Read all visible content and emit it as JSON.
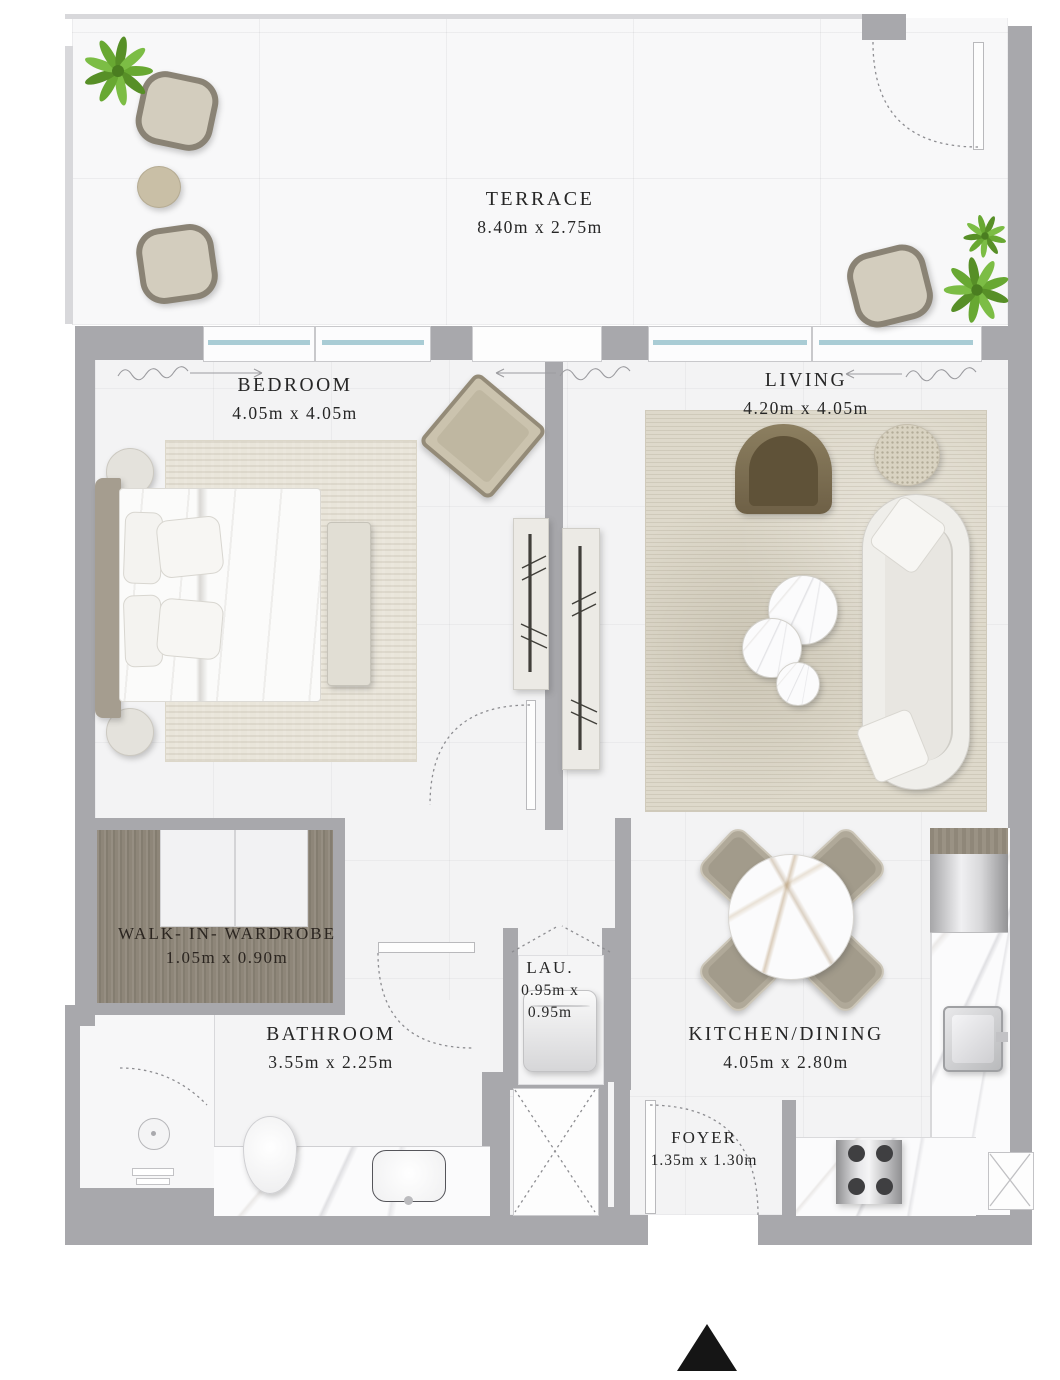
{
  "plan": {
    "rooms": [
      {
        "id": "terrace",
        "name": "TERRACE",
        "dims": "8.40m x 2.75m"
      },
      {
        "id": "bedroom",
        "name": "BEDROOM",
        "dims": "4.05m x 4.05m"
      },
      {
        "id": "living",
        "name": "LIVING",
        "dims": "4.20m x 4.05m"
      },
      {
        "id": "walk-in-wardrobe",
        "name": "WALK- IN- WARDROBE",
        "dims": "1.05m x 0.90m"
      },
      {
        "id": "bathroom",
        "name": "BATHROOM",
        "dims": "3.55m x 2.25m"
      },
      {
        "id": "laundry",
        "name": "LAU.",
        "dims_line1": "0.95m x",
        "dims_line2": "0.95m"
      },
      {
        "id": "kitchen-dining",
        "name": "KITCHEN/DINING",
        "dims": "4.05m x 2.80m"
      },
      {
        "id": "foyer",
        "name": "FOYER",
        "dims": "1.35m x 1.30m"
      }
    ],
    "colors": {
      "wall": "#a8a8ac",
      "floor": "#f3f3f4",
      "terrace_floor": "#f8f8f9",
      "window_glass": "#a9ccd5",
      "wardrobe_wood": "#8e8679",
      "label_text": "#262626",
      "plant_green": "#68a832",
      "north_arrow": "#151515"
    },
    "icons": [
      "plant-icon",
      "north-arrow-icon",
      "door-swing-arc",
      "curtain-mark",
      "hanging-rail-icon",
      "duct-cross-icon",
      "ac-cross-icon",
      "shower-head-icon"
    ]
  }
}
